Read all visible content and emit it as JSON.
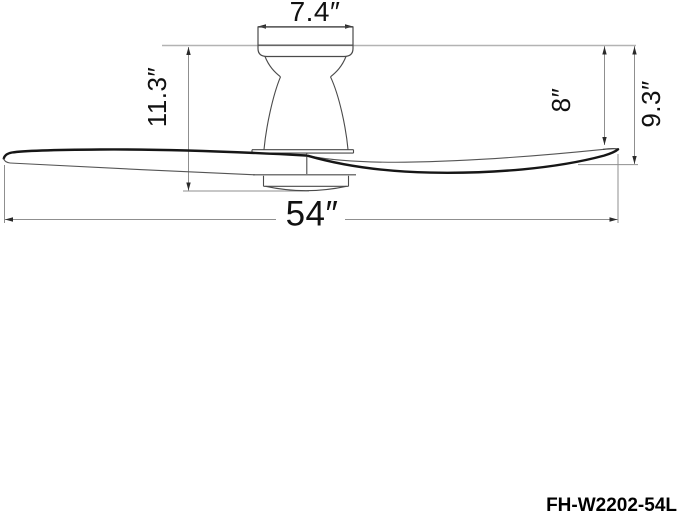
{
  "drawing": {
    "dimensions": {
      "canopy_width": "7.4″",
      "ceiling_to_fan_bottom": "11.3″",
      "ceiling_to_blade_tip_top": "8″",
      "ceiling_to_blade_tip_bottom": "9.3″",
      "blade_span": "54″"
    },
    "model_number": "FH-W2202-54L",
    "colors": {
      "background": "#ffffff",
      "dimension_line": "#8f8f8f",
      "ceiling_line": "#b3b3b3",
      "outline": "#4a4a4a",
      "blade_edge": "#161616",
      "arrow": "#2a2a2a",
      "text": "#111111"
    }
  }
}
